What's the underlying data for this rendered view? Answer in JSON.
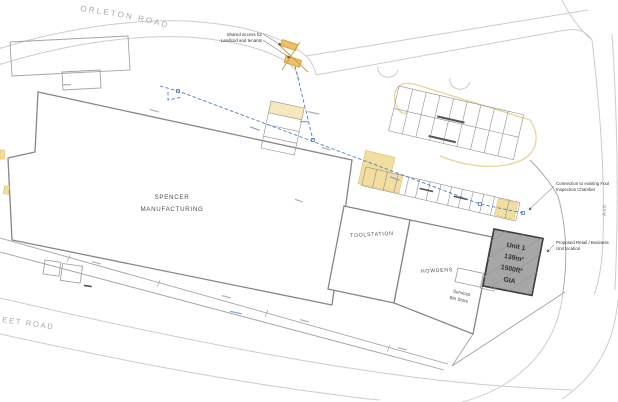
{
  "roads": {
    "orleton": "ORLETON ROAD",
    "sheet_partial": "EET ROAD",
    "a49": "A49"
  },
  "buildings": {
    "spencer": {
      "lines": [
        "SPENCER",
        "MANUFACTURING"
      ]
    },
    "toolstation": {
      "label": "TOOLSTATION"
    },
    "howdens": {
      "label": "HOWDENS"
    },
    "unit1": {
      "lines": [
        "Unit 1",
        "139m²",
        "1500ft²",
        "GIA"
      ]
    },
    "services": {
      "lines": [
        "Services",
        "Bin Store"
      ]
    }
  },
  "annotations": {
    "shared_access": {
      "lines": [
        "Shared access for",
        "Landlord and tenants"
      ]
    },
    "foul_connection": {
      "lines": [
        "Connection to existing Foul",
        "Inspection Chamber"
      ]
    },
    "proposed_unit": {
      "lines": [
        "Proposed Retail / Business",
        "Unit location"
      ]
    }
  },
  "colors": {
    "line_light": "#cccccc",
    "line_mid": "#a3a3a3",
    "line_dark": "#7d7d7d",
    "drainage_blue": "#4f7fbf",
    "highlight_yellow": "#f3dd9f",
    "access_orange": "#d9a23c",
    "unit_fill": "#a7a7a7",
    "unit_border": "#3d3d3d",
    "annotation_text": "#333333",
    "road_label_text": "#a8a8a8"
  }
}
